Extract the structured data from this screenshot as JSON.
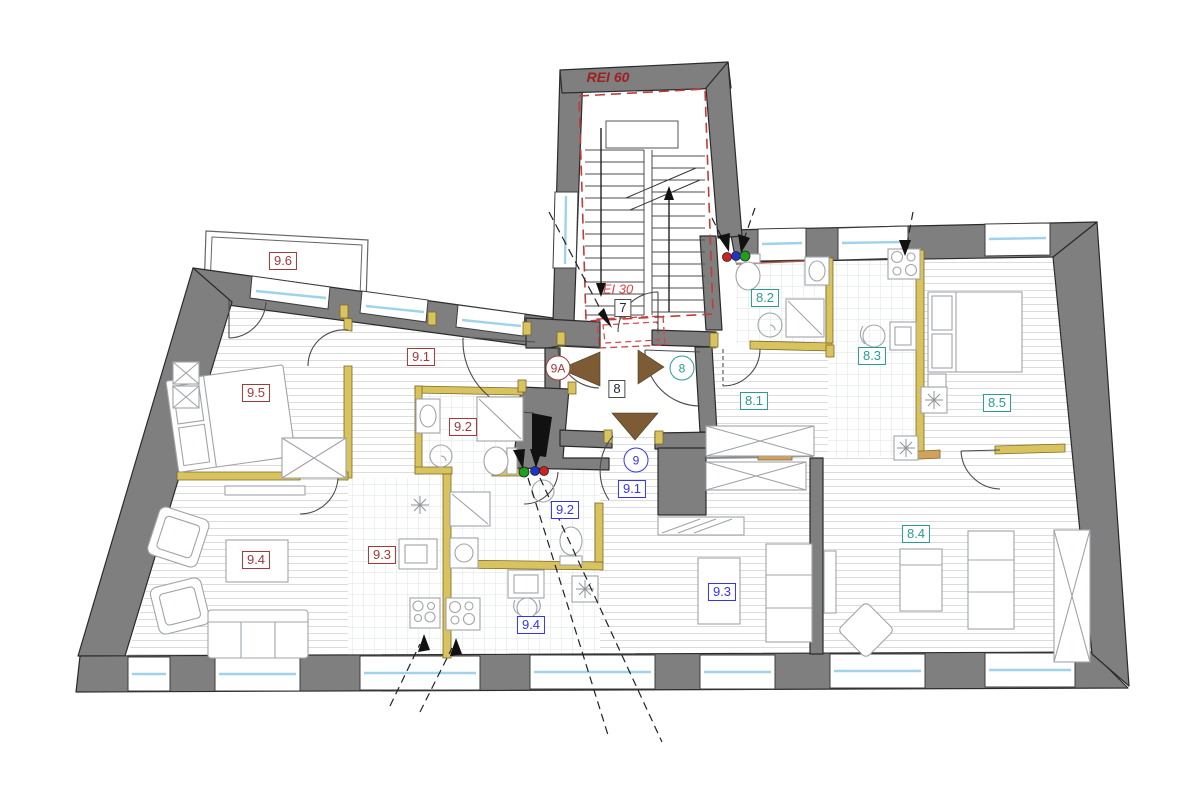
{
  "drawing": {
    "type": "apartment building floor plan",
    "stairwell": {
      "fire_rating_label": "REI 60",
      "stair_door_number": "7",
      "stair_door_fire_rating_label": "EI 30"
    },
    "entry_hall_number": "8",
    "entrance_markers": {
      "apartment_9a": "9A",
      "apartment_8": "8",
      "apartment_9": "9"
    },
    "apartment_8_rooms": [
      "8.1",
      "8.2",
      "8.3",
      "8.4",
      "8.5"
    ],
    "apartment_9_red_rooms": [
      "9.1",
      "9.2",
      "9.3",
      "9.4",
      "9.5",
      "9.6"
    ],
    "apartment_9_blue_rooms": [
      "9.1",
      "9.2",
      "9.3",
      "9.4"
    ]
  },
  "labels": [
    {
      "id": "rei60",
      "text": "REI 60",
      "color": "firebold",
      "shape": "text"
    },
    {
      "id": "ei30",
      "text": "EI 30",
      "color": "fire",
      "shape": "text"
    },
    {
      "id": "k7",
      "text": "7",
      "color": "black",
      "shape": "box"
    },
    {
      "id": "k8",
      "text": "8",
      "color": "black",
      "shape": "box"
    },
    {
      "id": "c9a",
      "text": "9A",
      "color": "red",
      "shape": "circle"
    },
    {
      "id": "c8",
      "text": "8",
      "color": "teal",
      "shape": "circle"
    },
    {
      "id": "c9",
      "text": "9",
      "color": "blue",
      "shape": "circle"
    },
    {
      "id": "r96",
      "text": "9.6",
      "color": "red",
      "shape": "box"
    },
    {
      "id": "r95",
      "text": "9.5",
      "color": "red",
      "shape": "box"
    },
    {
      "id": "r91",
      "text": "9.1",
      "color": "red",
      "shape": "box"
    },
    {
      "id": "r92",
      "text": "9.2",
      "color": "red",
      "shape": "box"
    },
    {
      "id": "r93",
      "text": "9.3",
      "color": "red",
      "shape": "box"
    },
    {
      "id": "r94",
      "text": "9.4",
      "color": "red",
      "shape": "box"
    },
    {
      "id": "t82",
      "text": "8.2",
      "color": "teal",
      "shape": "box"
    },
    {
      "id": "t83",
      "text": "8.3",
      "color": "teal",
      "shape": "box"
    },
    {
      "id": "t81",
      "text": "8.1",
      "color": "teal",
      "shape": "box"
    },
    {
      "id": "t85",
      "text": "8.5",
      "color": "teal",
      "shape": "box"
    },
    {
      "id": "t84",
      "text": "8.4",
      "color": "teal",
      "shape": "box"
    },
    {
      "id": "b91",
      "text": "9.1",
      "color": "blue",
      "shape": "box"
    },
    {
      "id": "b92",
      "text": "9.2",
      "color": "blue",
      "shape": "box"
    },
    {
      "id": "b93",
      "text": "9.3",
      "color": "blue",
      "shape": "box"
    },
    {
      "id": "b94",
      "text": "9.4",
      "color": "blue",
      "shape": "box"
    }
  ],
  "colors": {
    "wall_gray": "#7f7f7f",
    "new_wall_yellow": "#d9c35f",
    "window_blue": "#9fd3ec",
    "label_red": "#a33838",
    "label_teal": "#2a9a96",
    "label_blue": "#3434ee",
    "fire_dash_red": "#c23b3b",
    "entrance_arrow_brown": "#7d5b35",
    "utility_marker_red": "#cc2222",
    "utility_marker_blue": "#2233cc",
    "utility_marker_green": "#1f9e1f"
  }
}
